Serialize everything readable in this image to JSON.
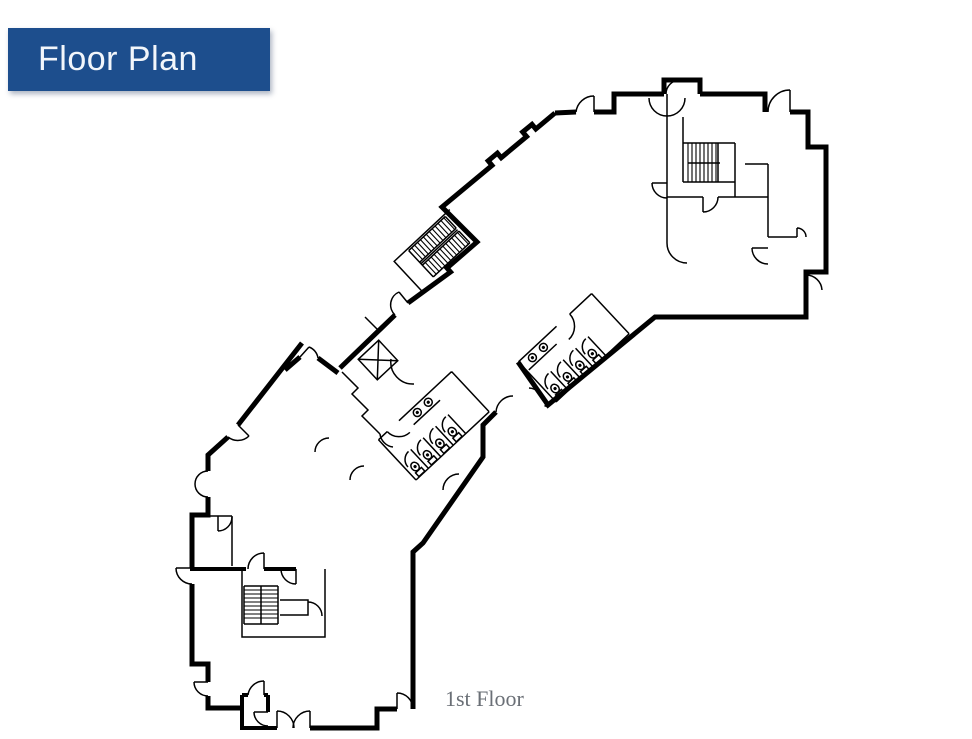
{
  "header": {
    "title": "Floor Plan"
  },
  "caption": {
    "text": "1st Floor"
  },
  "colors": {
    "header-bg": "#1d4e8d",
    "header-text": "#f2f6fb",
    "caption-text": "#6a6f76",
    "wall": "#000000",
    "bg": "#ffffff"
  },
  "plan": {
    "floor_label": "1st Floor",
    "features": [
      "exterior-walls",
      "stairwell-upper-right",
      "stairwell-lower-left",
      "staircase-middle",
      "elevator",
      "restroom-upper",
      "restroom-lower",
      "entrance-vestibule",
      "door-swings"
    ]
  }
}
